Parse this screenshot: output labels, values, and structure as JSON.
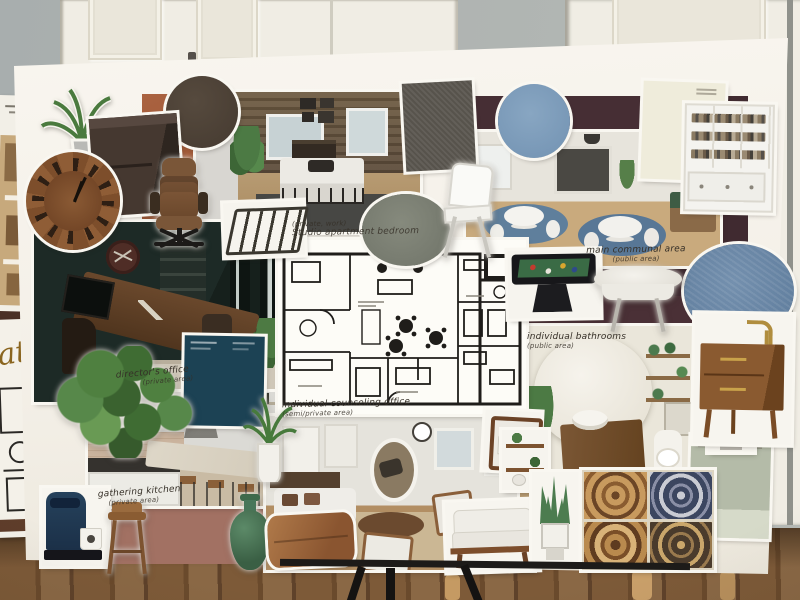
{
  "scene": {
    "subject": "Photograph of an interior-design mood board collage standing on a black easel in front of white paneled doors and a wood floor"
  },
  "labels": {
    "bedroom_note": "(private, work)",
    "bedroom": "Studio apartment bedroom",
    "communal": "main communal area",
    "communal_note": "(public area)",
    "bathrooms": "individual bathrooms",
    "bathrooms_note": "(public area)",
    "director": "director's office",
    "director_note": "(private area)",
    "kitchen": "gathering kitchen",
    "kitchen_note": "(private area)",
    "counseling": "individual counseling office",
    "counseling_note": "(semi/private area)",
    "side_paper_script": "ation"
  },
  "colors": {
    "wall": "#aeb3b1",
    "door": "#f0ede4",
    "floor_wood": "#6e4d2f",
    "board": "#f6f3ec",
    "maroon_backing": "#402a30",
    "rust_backing": "#a05a3a",
    "terracotta_backing": "#a27163",
    "swatch_dark_brown_circle": "#4c4036",
    "swatch_gray_green_circle": "#7c8074",
    "swatch_slate_blue_circle": "#7e9dbb",
    "swatch_denim_blue_circle": "#6886a6",
    "swatch_gray_fabric": "#57534c",
    "paint_card_cream": "#efecdb",
    "paint_card_teal": "#1c4254",
    "paint_card_sage": "#b4bba8"
  },
  "cutouts": [
    "palm plant",
    "dark cabinet",
    "wood wall clock",
    "leather office chair",
    "metal bed frame",
    "white folding chair",
    "white bookshelf",
    "pool table",
    "round folding table",
    "ivy plant",
    "keurig coffee maker",
    "bar stool",
    "green vase",
    "leather pillow",
    "potted palm",
    "wood armchair",
    "floating shelves",
    "white sofa",
    "snake plant planter",
    "patterned tiles",
    "wood vanity",
    "snake plant"
  ]
}
